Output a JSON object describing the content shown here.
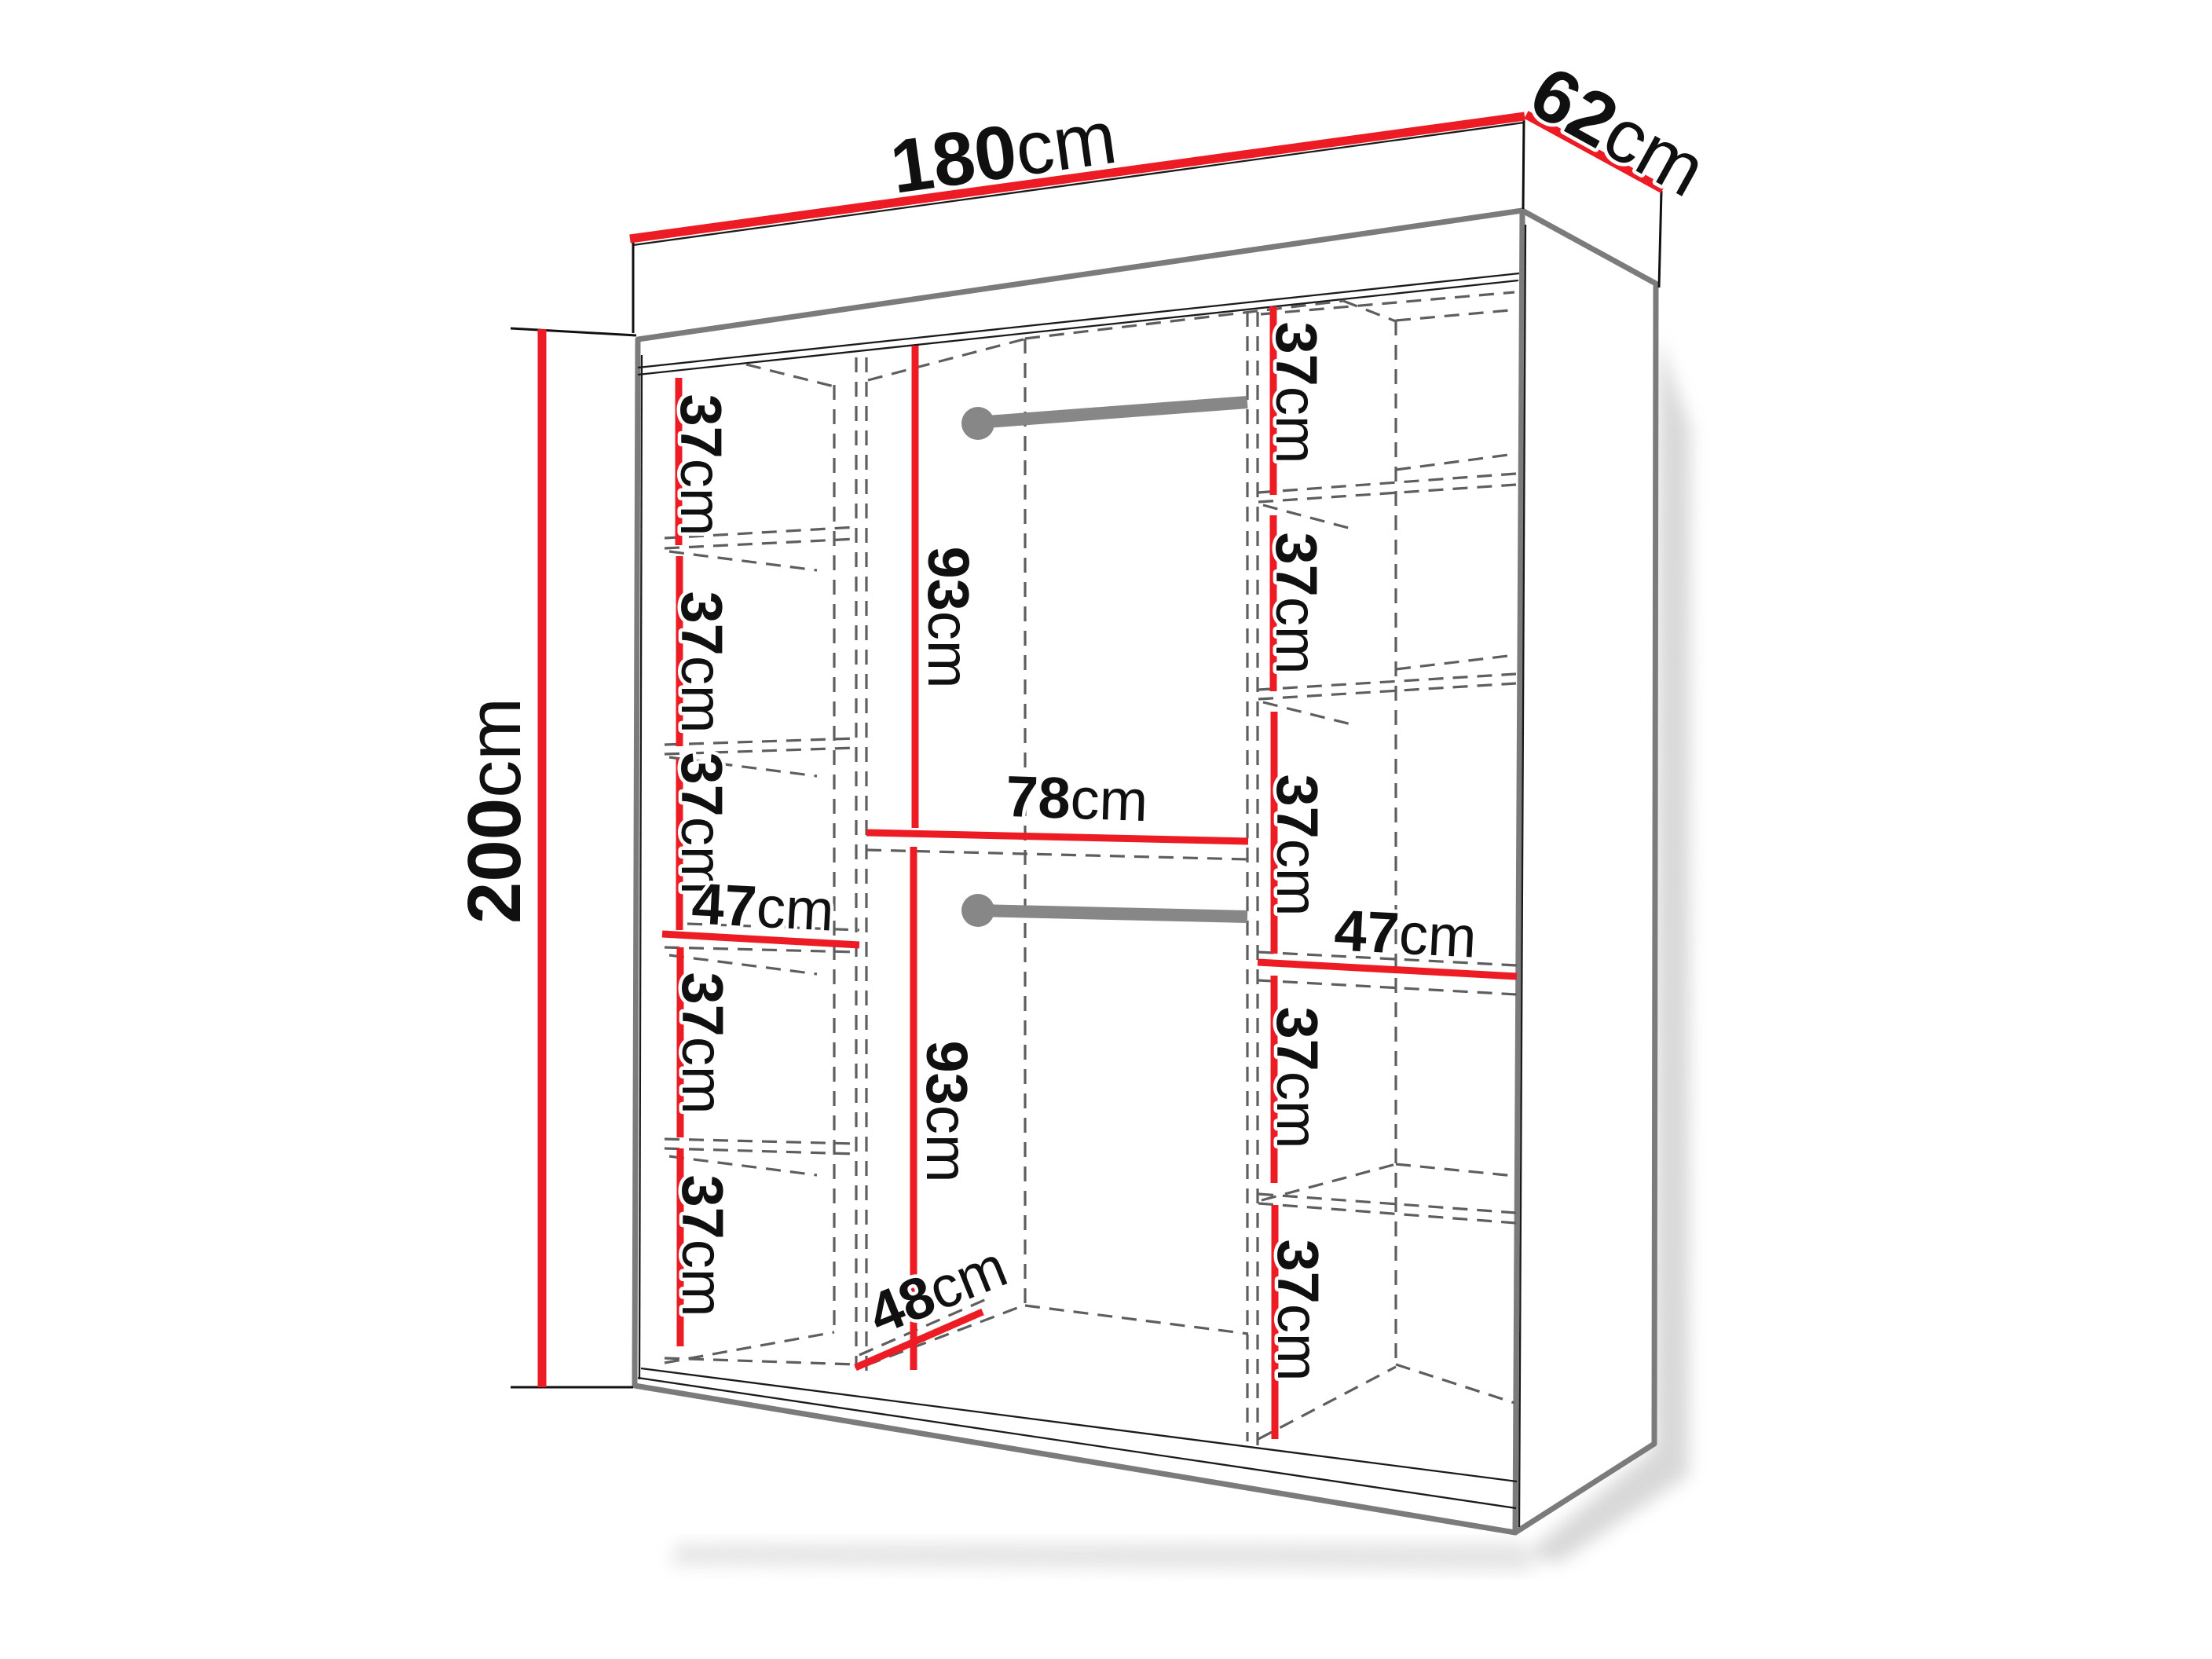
{
  "diagram_title": "Wardrobe interior dimension drawing",
  "unit": "cm",
  "colors": {
    "dim-red": "#ED1C24",
    "edge-gray": "#7B7B7B",
    "dash-gray": "#5E5E5E",
    "rod-gray": "#878787"
  },
  "dimensions": {
    "overall_width": {
      "num": "180",
      "unit": "cm"
    },
    "overall_depth": {
      "num": "62",
      "unit": "cm"
    },
    "overall_height": {
      "num": "200",
      "unit": "cm"
    },
    "left_column": {
      "width": {
        "num": "47",
        "unit": "cm"
      },
      "sections": [
        {
          "num": "37",
          "unit": "cm"
        },
        {
          "num": "37",
          "unit": "cm"
        },
        {
          "num": "37",
          "unit": "cm"
        },
        {
          "num": "37",
          "unit": "cm"
        },
        {
          "num": "37",
          "unit": "cm"
        }
      ]
    },
    "middle_column": {
      "upper_hanging_height": {
        "num": "93",
        "unit": "cm"
      },
      "middle_shelf_width": {
        "num": "78",
        "unit": "cm"
      },
      "lower_hanging_height": {
        "num": "93",
        "unit": "cm"
      },
      "bottom_depth": {
        "num": "48",
        "unit": "cm"
      }
    },
    "right_column": {
      "width": {
        "num": "47",
        "unit": "cm"
      },
      "sections": [
        {
          "num": "37",
          "unit": "cm"
        },
        {
          "num": "37",
          "unit": "cm"
        },
        {
          "num": "37",
          "unit": "cm"
        },
        {
          "num": "37",
          "unit": "cm"
        },
        {
          "num": "37",
          "unit": "cm"
        }
      ]
    }
  }
}
